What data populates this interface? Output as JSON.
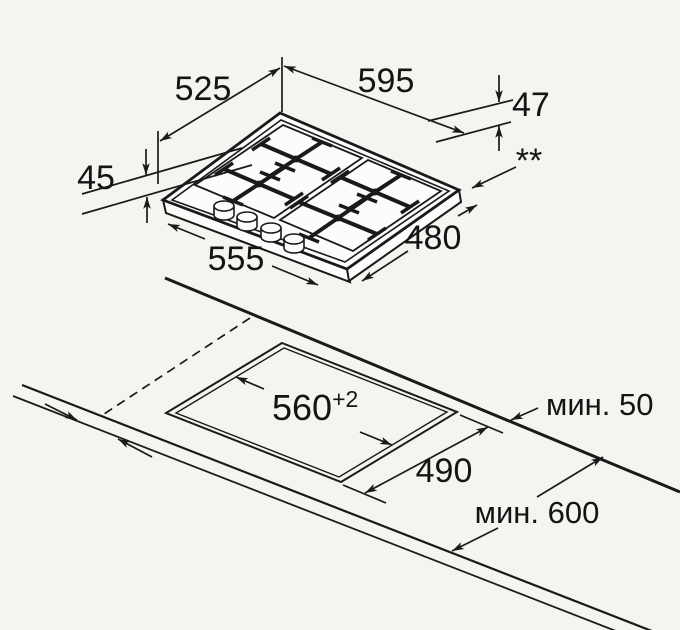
{
  "colors": {
    "background": "#f4f4f1",
    "line": "#1a1a1a",
    "text": "#141414"
  },
  "hob_view": {
    "description_of_icons": "isometric-gas-hob-drawing",
    "dimensions": {
      "grate_area_depth": "525",
      "overall_width": "595",
      "height_below_rim": "47",
      "height_above_worktop": "45",
      "grate_area_width": "555",
      "overall_depth": "480",
      "footnote_marker": "**"
    }
  },
  "cutout_view": {
    "description_of_icons": "worktop-cutout-drawing",
    "dimensions": {
      "cutout_width": "560",
      "cutout_width_tolerance": "+2",
      "cutout_depth": "490",
      "min_rear_clearance": "мин. 50",
      "min_worktop_depth": "мин. 600"
    }
  }
}
